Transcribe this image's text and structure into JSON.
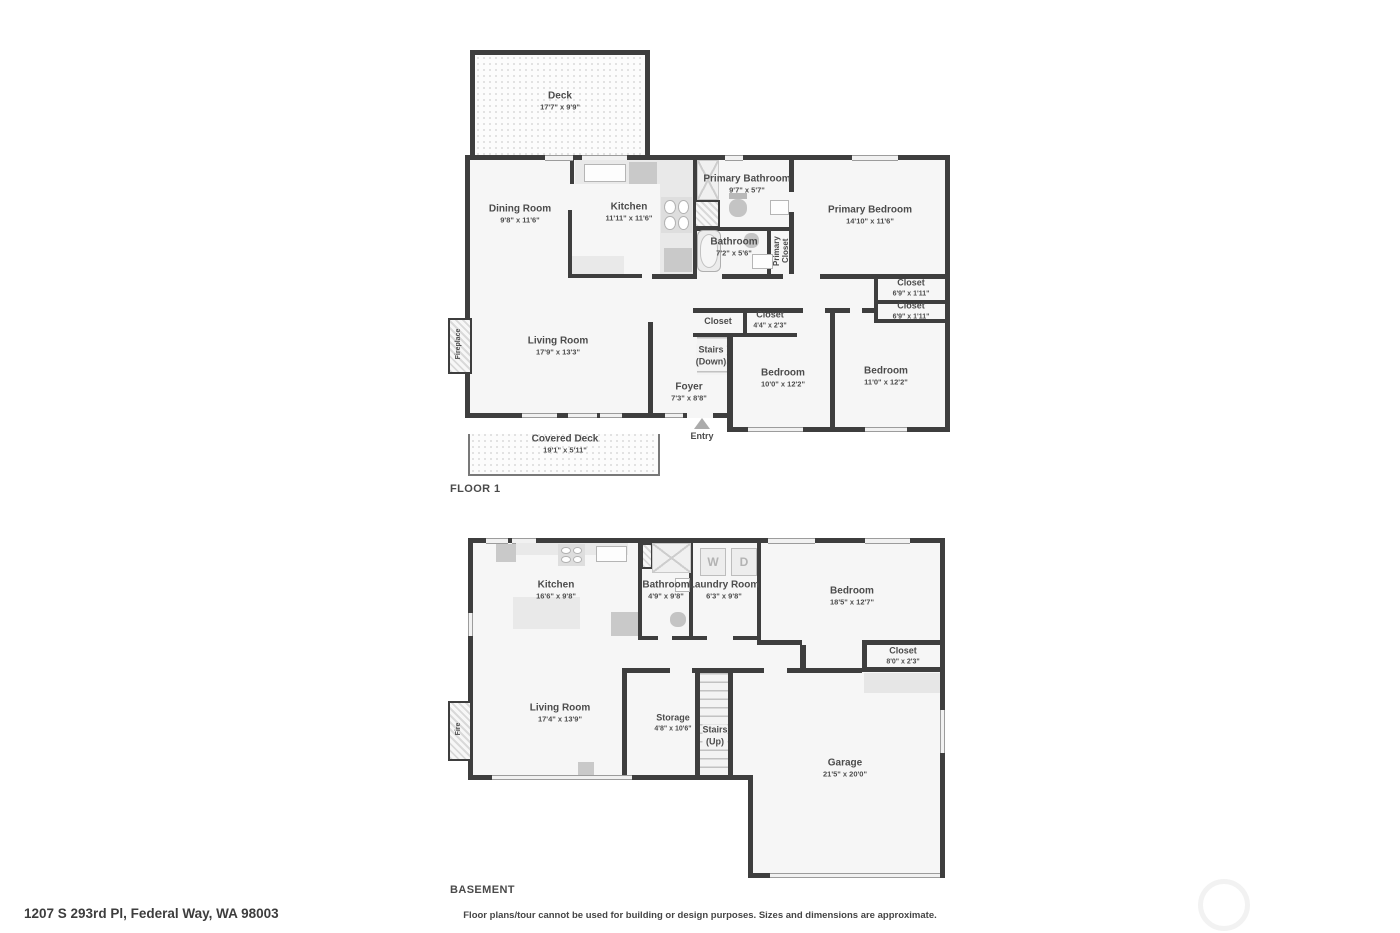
{
  "page": {
    "floor1_title": "FLOOR 1",
    "basement_title": "BASEMENT",
    "address": "1207 S 293rd Pl, Federal Way, WA 98003",
    "disclaimer": "Floor plans/tour cannot be used for building or design purposes. Sizes and dimensions are approximate."
  },
  "colors": {
    "wall": "#3e3e3e",
    "room_fill": "#f6f6f6",
    "fixture": "#e9e9e9",
    "text": "#4c4c4c"
  },
  "floor1": {
    "deck": {
      "name": "Deck",
      "dims": "17'7\" x 9'9\""
    },
    "dining": {
      "name": "Dining Room",
      "dims": "9'8\" x 11'6\""
    },
    "kitchen": {
      "name": "Kitchen",
      "dims": "11'11\" x 11'6\""
    },
    "primary_bathroom": {
      "name": "Primary Bathroom",
      "dims": "9'7\" x 5'7\""
    },
    "bathroom": {
      "name": "Bathroom",
      "dims": "7'2\" x 5'6\""
    },
    "primary_closet": {
      "name": "Primary Closet"
    },
    "primary_bedroom": {
      "name": "Primary Bedroom",
      "dims": "14'10\" x 11'6\""
    },
    "closet_a": {
      "name": "Closet",
      "dims": "6'9\" x 1'11\""
    },
    "closet_b": {
      "name": "Closet",
      "dims": "6'9\" x 1'11\""
    },
    "closet_c": {
      "name": "Closet"
    },
    "closet_d": {
      "name": "Closet",
      "dims": "4'4\" x 2'3\""
    },
    "stairs": {
      "line1": "Stairs",
      "line2": "(Down)"
    },
    "foyer": {
      "name": "Foyer",
      "dims": "7'3\" x 8'8\""
    },
    "bedroom_a": {
      "name": "Bedroom",
      "dims": "10'0\" x 12'2\""
    },
    "bedroom_b": {
      "name": "Bedroom",
      "dims": "11'0\" x 12'2\""
    },
    "living": {
      "name": "Living Room",
      "dims": "17'9\" x 13'3\""
    },
    "covered_deck": {
      "name": "Covered Deck",
      "dims": "19'1\" x 5'11\""
    },
    "fireplace": {
      "name": "Fireplace"
    },
    "entry": {
      "name": "Entry"
    }
  },
  "basement": {
    "kitchen": {
      "name": "Kitchen",
      "dims": "16'6\" x 9'8\""
    },
    "bathroom": {
      "name": "Bathroom",
      "dims": "4'9\" x 9'8\""
    },
    "laundry": {
      "name": "Laundry Room",
      "dims": "6'3\" x 9'8\""
    },
    "washer": "W",
    "dryer": "D",
    "bedroom": {
      "name": "Bedroom",
      "dims": "18'5\" x 12'7\""
    },
    "closet": {
      "name": "Closet",
      "dims": "8'0\" x 2'3\""
    },
    "living": {
      "name": "Living Room",
      "dims": "17'4\" x 13'9\""
    },
    "storage": {
      "name": "Storage",
      "dims": "4'8\" x 10'6\""
    },
    "stairs": {
      "line1": "Stairs",
      "line2": "(Up)"
    },
    "garage": {
      "name": "Garage",
      "dims": "21'5\" x 20'0\""
    },
    "fireplace": {
      "name": "Fire"
    }
  }
}
